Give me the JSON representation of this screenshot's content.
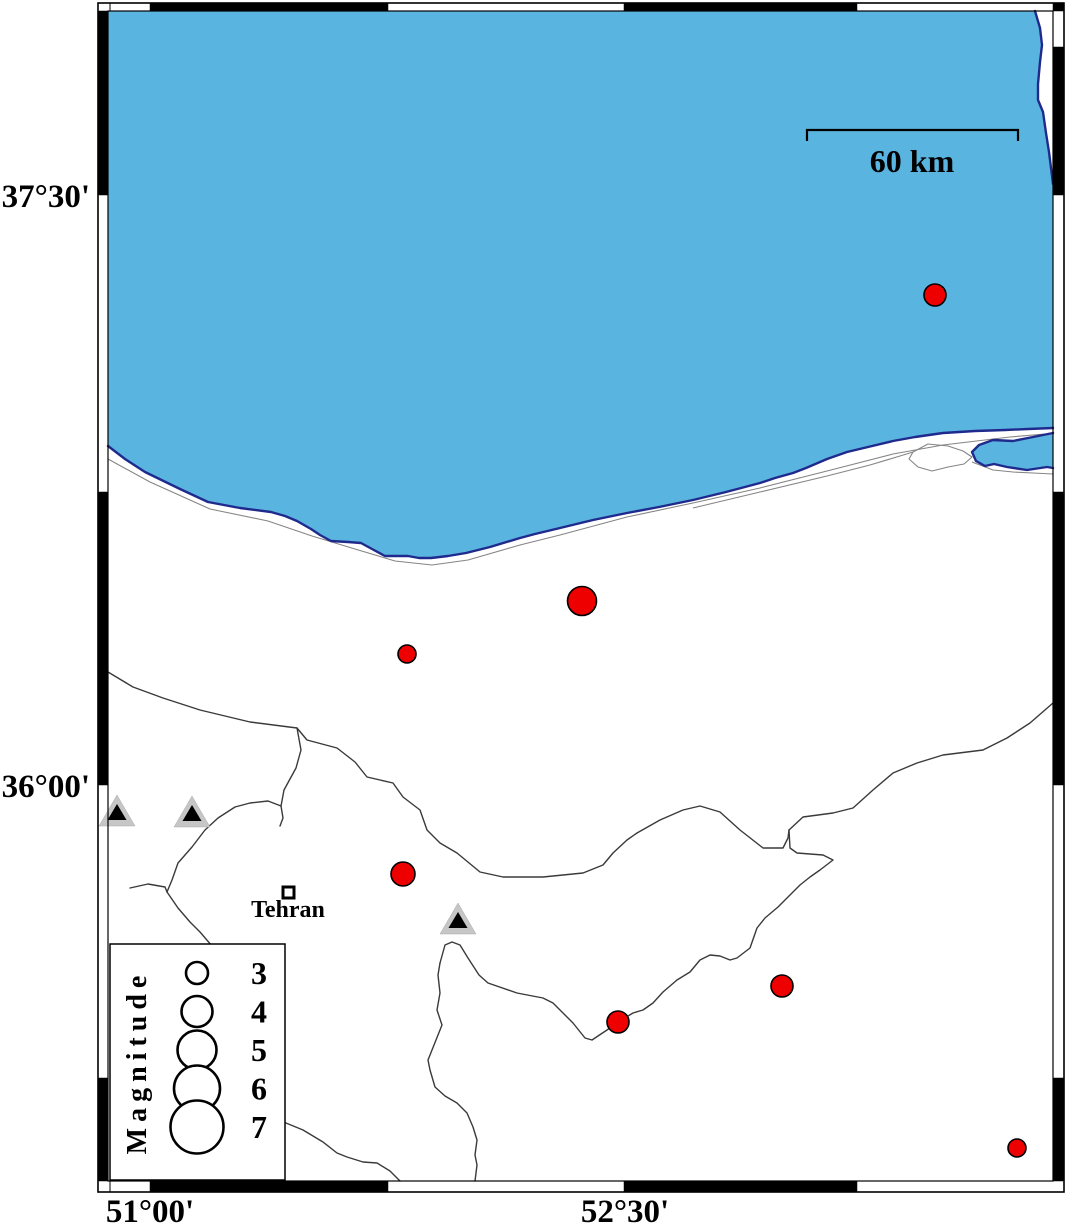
{
  "axis": {
    "lat_top": "37°30'",
    "lat_bottom": "36°00'",
    "lon_left": "51°00'",
    "lon_right": "52°30'"
  },
  "scalebar": {
    "label": "60 km"
  },
  "city": {
    "name": "Tehran"
  },
  "legend": {
    "title": "Magnitude",
    "entries": [
      {
        "label": "3",
        "radius": 11
      },
      {
        "label": "4",
        "radius": 15.5
      },
      {
        "label": "5",
        "radius": 19.5
      },
      {
        "label": "6",
        "radius": 23
      },
      {
        "label": "7",
        "radius": 26.5
      }
    ]
  },
  "colors": {
    "sea": "#5ab4e0",
    "coast_outline": "#1f2a8c",
    "earthquake": "#ee0000",
    "volcano_gray": "#c6c6c6"
  },
  "map": {
    "earthquakes_px": [
      {
        "x": 935,
        "y": 295,
        "r": 11
      },
      {
        "x": 582,
        "y": 601,
        "r": 14.5
      },
      {
        "x": 407,
        "y": 654,
        "r": 9
      },
      {
        "x": 403,
        "y": 874,
        "r": 12
      },
      {
        "x": 782,
        "y": 986,
        "r": 11
      },
      {
        "x": 618,
        "y": 1022,
        "r": 11
      },
      {
        "x": 1017,
        "y": 1148,
        "r": 9
      }
    ],
    "volcanoes_px": [
      {
        "x": 117,
        "y": 826
      },
      {
        "x": 192,
        "y": 827
      },
      {
        "x": 458,
        "y": 934
      }
    ]
  }
}
